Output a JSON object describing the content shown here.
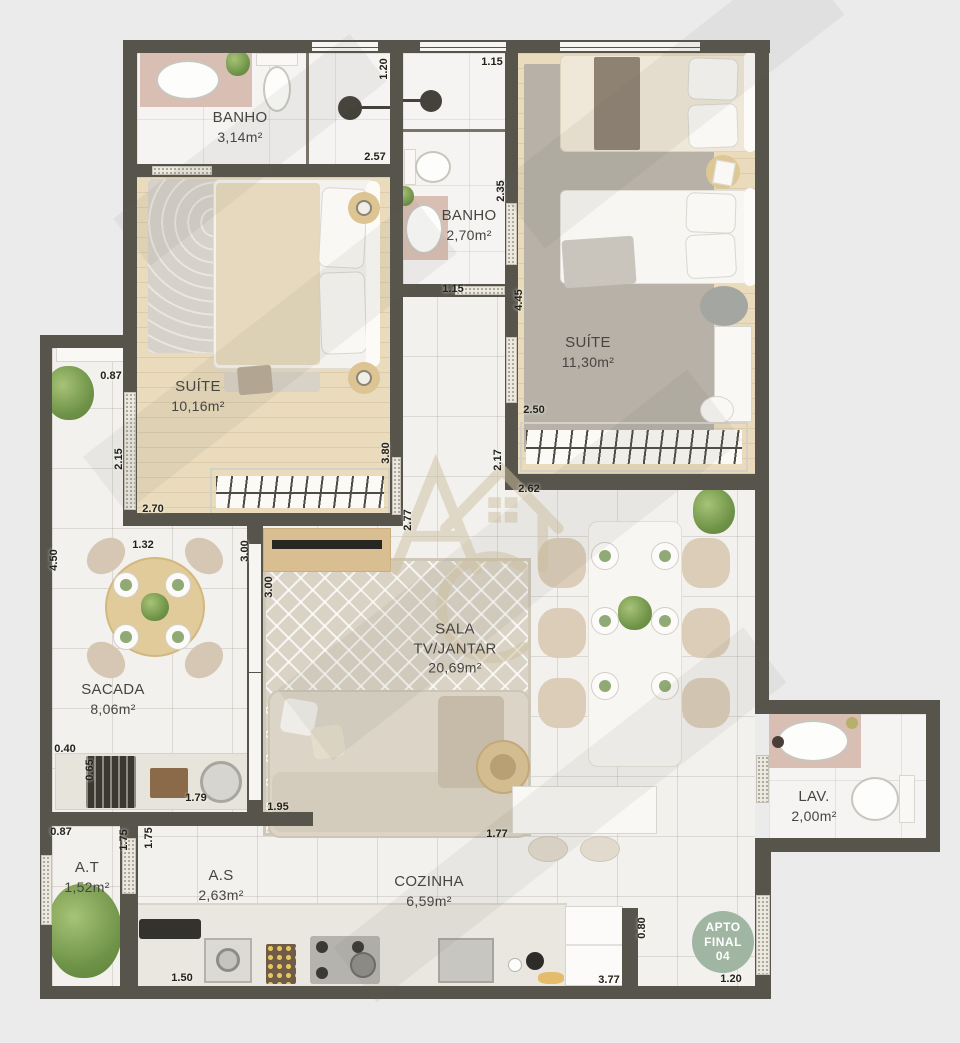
{
  "palette": {
    "background": "#ebebec",
    "wall": "#57544b",
    "accent_pink": "#d9bfb3",
    "badge_green": "#a0b5a2",
    "wood_floor": "#e9dbbc"
  },
  "watermark": {
    "letter_a": "A",
    "letter_c": "C"
  },
  "badge": {
    "line1": "APTO",
    "line2": "FINAL",
    "line3": "04"
  },
  "rooms": [
    {
      "id": "banho-1",
      "name": "BANHO",
      "area": "3,14m²",
      "x": 240,
      "y": 127
    },
    {
      "id": "banho-2",
      "name": "BANHO",
      "area": "2,70m²",
      "x": 469,
      "y": 225
    },
    {
      "id": "suite-2",
      "name": "SUÍTE",
      "area": "11,30m²",
      "x": 588,
      "y": 352
    },
    {
      "id": "suite-1",
      "name": "SUÍTE",
      "area": "10,16m²",
      "x": 198,
      "y": 396
    },
    {
      "id": "sacada",
      "name": "SACADA",
      "area": "8,06m²",
      "x": 113,
      "y": 699
    },
    {
      "id": "sala",
      "name": "SALA",
      "line2": "TV/JANTAR",
      "area": "20,69m²",
      "x": 455,
      "y": 648
    },
    {
      "id": "lav",
      "name": "LAV.",
      "area": "2,00m²",
      "x": 814,
      "y": 806
    },
    {
      "id": "at",
      "name": "A.T",
      "area": "1,52m²",
      "x": 87,
      "y": 877
    },
    {
      "id": "as",
      "name": "A.S",
      "area": "2,63m²",
      "x": 221,
      "y": 885
    },
    {
      "id": "cozinha",
      "name": "COZINHA",
      "area": "6,59m²",
      "x": 429,
      "y": 891
    }
  ],
  "measurements": [
    {
      "v": "1.20",
      "x": 384,
      "y": 69,
      "r": -90
    },
    {
      "v": "1.15",
      "x": 492,
      "y": 62,
      "r": 0
    },
    {
      "v": "2.57",
      "x": 375,
      "y": 157,
      "r": 0
    },
    {
      "v": "2.35",
      "x": 501,
      "y": 191,
      "r": -90
    },
    {
      "v": "1.15",
      "x": 453,
      "y": 289,
      "r": 0
    },
    {
      "v": "4.45",
      "x": 519,
      "y": 300,
      "r": -90
    },
    {
      "v": "2.50",
      "x": 534,
      "y": 410,
      "r": 0
    },
    {
      "v": "2.17",
      "x": 498,
      "y": 460,
      "r": -90
    },
    {
      "v": "2.62",
      "x": 529,
      "y": 489,
      "r": 0
    },
    {
      "v": "2.77",
      "x": 408,
      "y": 520,
      "r": -90
    },
    {
      "v": "0.87",
      "x": 111,
      "y": 376,
      "r": 0
    },
    {
      "v": "2.15",
      "x": 119,
      "y": 459,
      "r": -90
    },
    {
      "v": "2.70",
      "x": 153,
      "y": 509,
      "r": 0
    },
    {
      "v": "3.80",
      "x": 386,
      "y": 453,
      "r": -90
    },
    {
      "v": "1.32",
      "x": 143,
      "y": 545,
      "r": 0
    },
    {
      "v": "3.00",
      "x": 245,
      "y": 551,
      "r": -90
    },
    {
      "v": "3.00",
      "x": 269,
      "y": 587,
      "r": -90
    },
    {
      "v": "4.50",
      "x": 54,
      "y": 560,
      "r": -90
    },
    {
      "v": "0.40",
      "x": 65,
      "y": 749,
      "r": 0
    },
    {
      "v": "0.65",
      "x": 90,
      "y": 770,
      "r": -90
    },
    {
      "v": "1.79",
      "x": 196,
      "y": 798,
      "r": 0
    },
    {
      "v": "1.95",
      "x": 278,
      "y": 807,
      "r": 0
    },
    {
      "v": "0.87",
      "x": 61,
      "y": 832,
      "r": 0
    },
    {
      "v": "1.75",
      "x": 124,
      "y": 840,
      "r": -90
    },
    {
      "v": "1.75",
      "x": 149,
      "y": 838,
      "r": -90
    },
    {
      "v": "1.50",
      "x": 182,
      "y": 978,
      "r": 0
    },
    {
      "v": "1.77",
      "x": 497,
      "y": 834,
      "r": 0
    },
    {
      "v": "3.77",
      "x": 609,
      "y": 980,
      "r": 0
    },
    {
      "v": "0.80",
      "x": 642,
      "y": 928,
      "r": -90
    },
    {
      "v": "1.20",
      "x": 731,
      "y": 979,
      "r": 0
    }
  ]
}
